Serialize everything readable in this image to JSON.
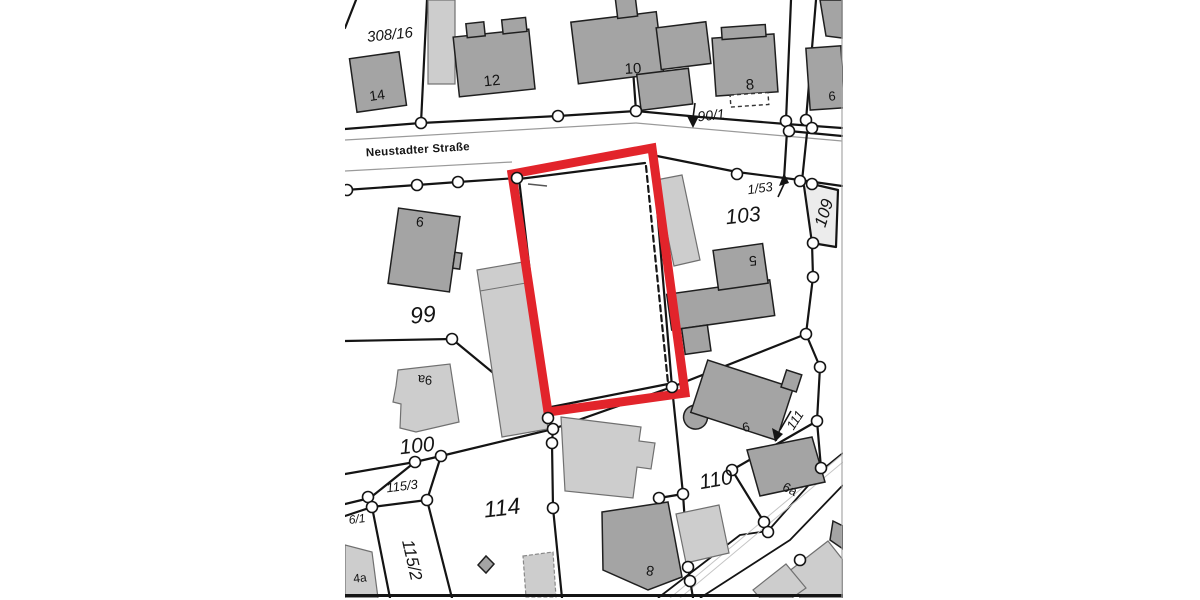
{
  "map": {
    "street_name": "Neustadter Straße",
    "parcel_labels": {
      "p308_16": "308/16",
      "p90_1": "90/1",
      "p1_53": "1/53",
      "p109": "109",
      "p103": "103",
      "p99": "99",
      "p100": "100",
      "p115_3": "115/3",
      "p6_1": "6/1",
      "p115_2": "115/2",
      "p114": "114",
      "p110": "110",
      "p111": "111"
    },
    "house_numbers": {
      "h14": "14",
      "h12": "12",
      "h10": "10",
      "h8_top": "8",
      "h6_top": "6",
      "h9": "9",
      "h5": "5",
      "h9a": "9a",
      "h4a": "4a",
      "h6_110": "6",
      "h6a": "6a",
      "h8_bottom": "8"
    },
    "colors": {
      "highlight_red": "#e2242b",
      "building_dark": "#a4a4a4",
      "building_light": "#cdcdcd",
      "line_black": "#141414",
      "street_thin": "#9a9a9a"
    }
  }
}
